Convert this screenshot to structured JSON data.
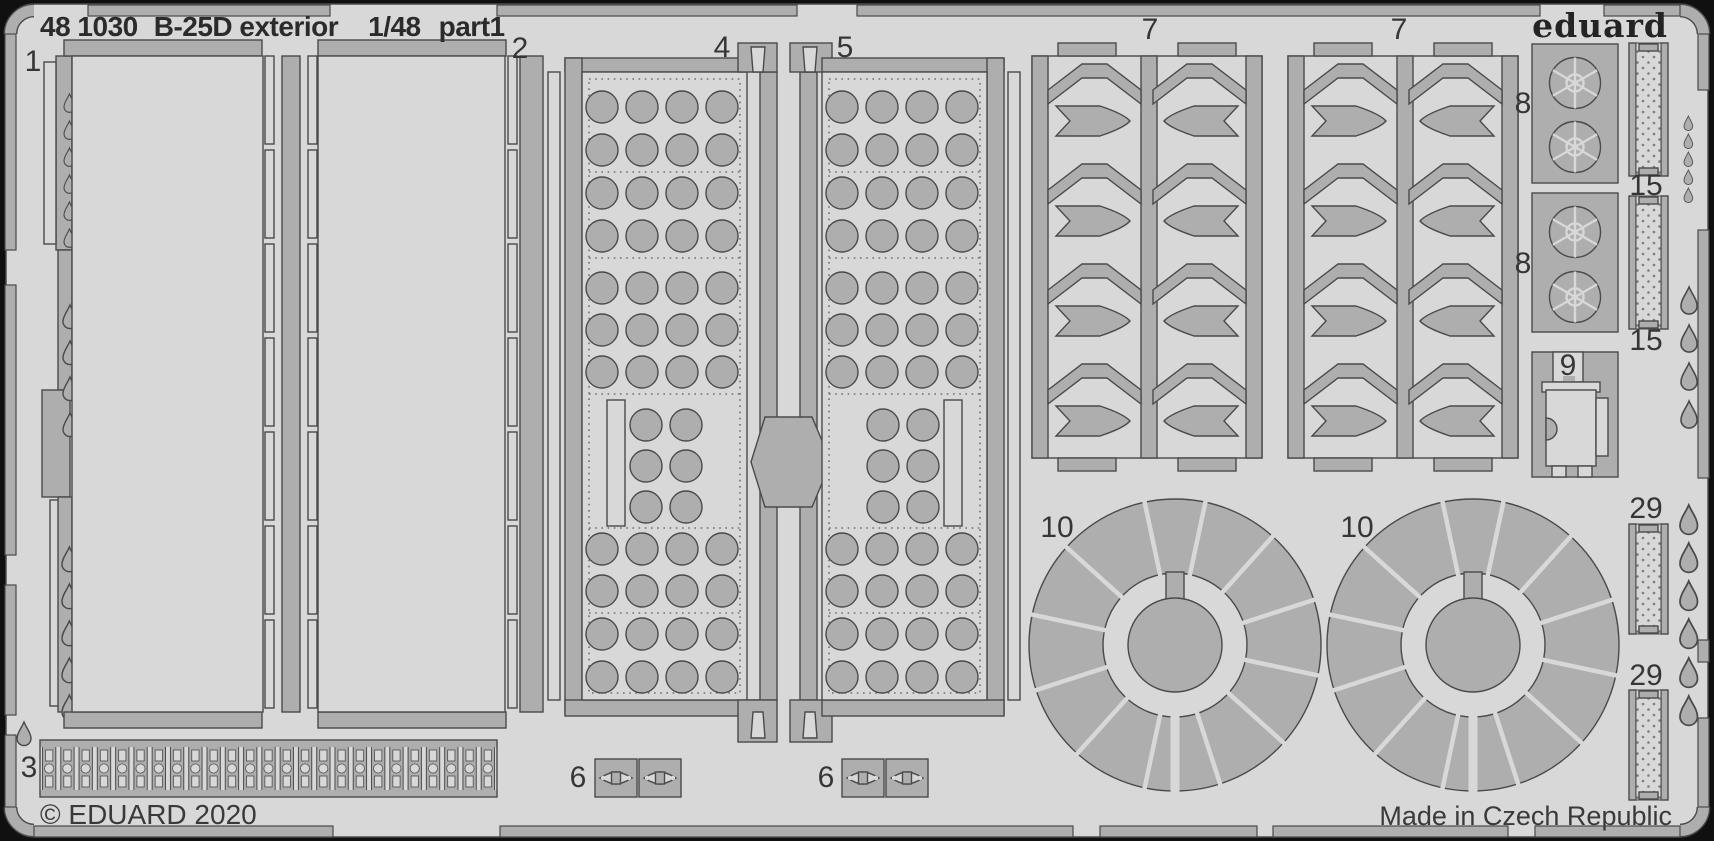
{
  "header": {
    "catalog": "48 1030",
    "title": "B-25D exterior",
    "scale": "1/48",
    "part": "part1"
  },
  "brand": {
    "logo_text": "eduard"
  },
  "footer": {
    "copyright": "© EDUARD 2020",
    "made_in": "Made in Czech Republic"
  },
  "part_labels": {
    "p1": "1",
    "p2": "2",
    "p3": "3",
    "p4": "4",
    "p5": "5",
    "p6": "6",
    "p7": "7",
    "p8": "8",
    "p9": "9",
    "p10": "10",
    "p15": "15",
    "p29": "29"
  },
  "colors": {
    "background": "#101010",
    "sheet": "#d8d8d8",
    "metal": "#aeaeae",
    "outline": "#4a4a4a",
    "rivet": "#6f6f6f",
    "label_text": "#363636"
  }
}
